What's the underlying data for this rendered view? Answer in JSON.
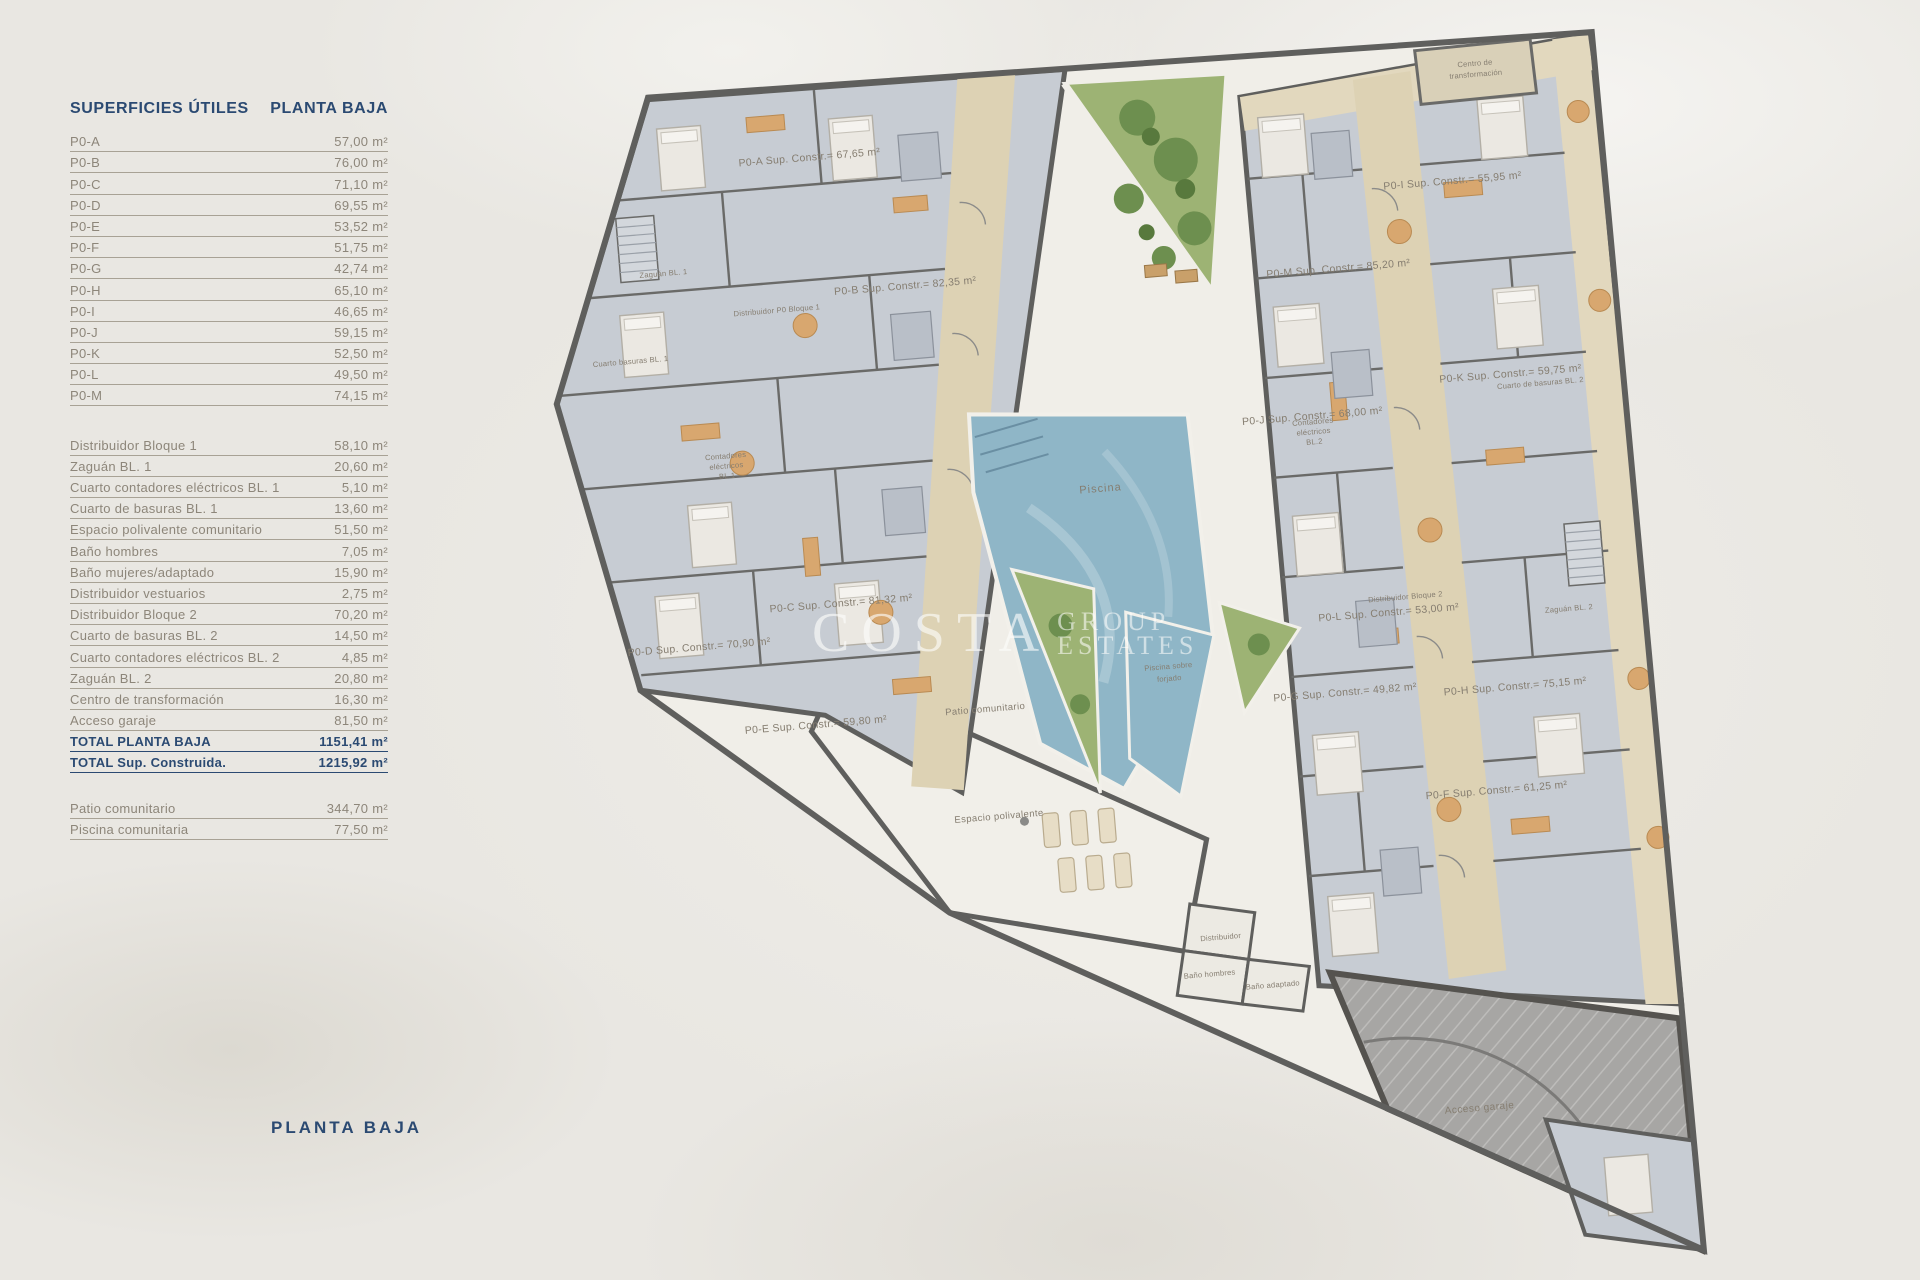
{
  "sidebar": {
    "header": {
      "title": "SUPERFICIES ÚTILES",
      "subtitle": "PLANTA BAJA"
    },
    "apartments": [
      {
        "label": "P0-A",
        "value": "57,00 m²"
      },
      {
        "label": "P0-B",
        "value": "76,00 m²"
      },
      {
        "label": "P0-C",
        "value": "71,10 m²"
      },
      {
        "label": "P0-D",
        "value": "69,55 m²"
      },
      {
        "label": "P0-E",
        "value": "53,52 m²"
      },
      {
        "label": "P0-F",
        "value": "51,75 m²"
      },
      {
        "label": "P0-G",
        "value": "42,74 m²"
      },
      {
        "label": "P0-H",
        "value": "65,10 m²"
      },
      {
        "label": "P0-I",
        "value": "46,65 m²"
      },
      {
        "label": "P0-J",
        "value": "59,15 m²"
      },
      {
        "label": "P0-K",
        "value": "52,50 m²"
      },
      {
        "label": "P0-L",
        "value": "49,50 m²"
      },
      {
        "label": "P0-M",
        "value": "74,15 m²"
      }
    ],
    "common": [
      {
        "label": "Distribuidor Bloque 1",
        "value": "58,10 m²"
      },
      {
        "label": "Zaguán BL. 1",
        "value": "20,60 m²"
      },
      {
        "label": "Cuarto contadores eléctricos BL. 1",
        "value": "5,10 m²"
      },
      {
        "label": "Cuarto de basuras BL. 1",
        "value": "13,60 m²"
      },
      {
        "label": "Espacio polivalente comunitario",
        "value": "51,50 m²"
      },
      {
        "label": "Baño hombres",
        "value": "7,05 m²"
      },
      {
        "label": "Baño mujeres/adaptado",
        "value": "15,90 m²"
      },
      {
        "label": "Distribuidor vestuarios",
        "value": "2,75 m²"
      },
      {
        "label": "Distribuidor Bloque 2",
        "value": "70,20 m²"
      },
      {
        "label": "Cuarto de basuras BL. 2",
        "value": "14,50 m²"
      },
      {
        "label": "Cuarto contadores eléctricos BL. 2",
        "value": "4,85 m²"
      },
      {
        "label": "Zaguán BL. 2",
        "value": "20,80 m²"
      },
      {
        "label": "Centro de transformación",
        "value": "16,30 m²"
      },
      {
        "label": "Acceso garaje",
        "value": "81,50 m²"
      }
    ],
    "totals": [
      {
        "label": "TOTAL PLANTA BAJA",
        "value": "1151,41 m²"
      },
      {
        "label": "TOTAL Sup. Construida.",
        "value": "1215,92 m²"
      }
    ],
    "outdoor": [
      {
        "label": "Patio comunitario",
        "value": "344,70 m²"
      },
      {
        "label": "Piscina comunitaria",
        "value": "77,50 m²"
      }
    ]
  },
  "footer_title": "PLANTA BAJA",
  "watermark": {
    "brand": "COSTA",
    "line2": "GROUP",
    "line3": "ESTATES"
  },
  "plan": {
    "colors": {
      "accent_navy": "#2b4a72",
      "text_gray": "#8d867a",
      "wall": "#5f5f5d",
      "room_floor": "#c7ccd3",
      "corridor_beige": "#ddd2b4",
      "pool_blue": "#8fb6c7",
      "garden_green": "#9db374",
      "patio_cream": "#f0eee8",
      "garage_gray": "#a7a6a4",
      "furniture_orange": "#d8a76f"
    },
    "unit_labels": [
      {
        "t": "P0-A Sup. Constr.= 67,65 m²"
      },
      {
        "t": "P0-B Sup. Constr.= 82,35 m²"
      },
      {
        "t": "P0-C Sup. Constr.= 81,32 m²"
      },
      {
        "t": "P0-D Sup. Constr.= 70,90 m²"
      },
      {
        "t": "P0-E Sup. Constr.= 59,80 m²"
      },
      {
        "t": "P0-F Sup. Constr.= 61,25 m²"
      },
      {
        "t": "P0-G Sup. Constr.= 49,82 m²"
      },
      {
        "t": "P0-H Sup. Constr.= 75,15 m²"
      },
      {
        "t": "P0-I Sup. Constr.= 55,95 m²"
      },
      {
        "t": "P0-J Sup. Constr.= 68,00 m²"
      },
      {
        "t": "P0-K Sup. Constr.= 59,75 m²"
      },
      {
        "t": "P0-L Sup. Constr.= 53,00 m²"
      },
      {
        "t": "P0-M Sup. Constr.= 85,20 m²"
      }
    ],
    "room_labels": [
      {
        "t": "Piscina"
      },
      {
        "t": "Piscina sobre"
      },
      {
        "t": "forjado"
      },
      {
        "t": "Patio comunitario"
      },
      {
        "t": "Espacio polivalente"
      },
      {
        "t": "Distribuidor"
      },
      {
        "t": "Baño hombres"
      },
      {
        "t": "Baño adaptado"
      },
      {
        "t": "Acceso garaje"
      },
      {
        "t": "Zaguán BL. 1"
      },
      {
        "t": "Distribuidor P0 Bloque 1"
      },
      {
        "t": "Cuarto basuras BL. 1"
      },
      {
        "t": "Contadores"
      },
      {
        "t": "eléctricos"
      },
      {
        "t": "BL.1"
      },
      {
        "t": "Distribuidor Bloque 2"
      },
      {
        "t": "Zaguán BL. 2"
      },
      {
        "t": "Cuarto de basuras BL. 2"
      },
      {
        "t": "Contadores"
      },
      {
        "t": "eléctricos"
      },
      {
        "t": "BL.2"
      },
      {
        "t": "Centro de"
      },
      {
        "t": "transformación"
      }
    ]
  }
}
